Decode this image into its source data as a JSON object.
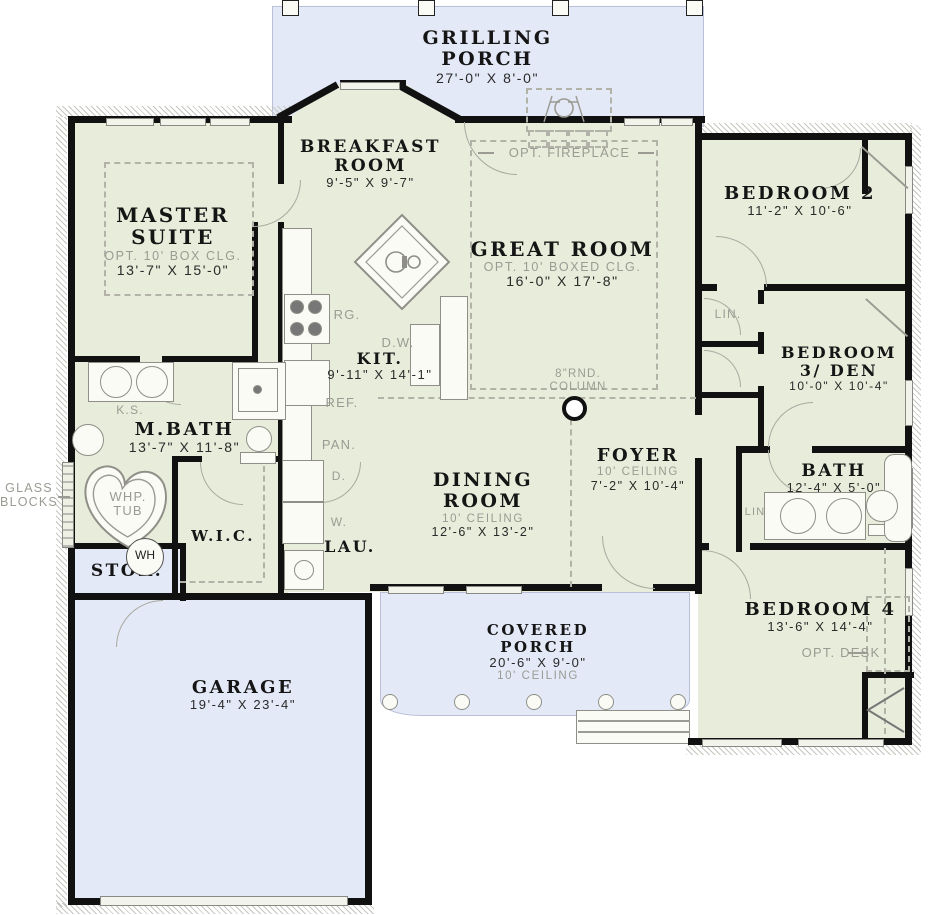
{
  "title": "Floor Plan",
  "colors": {
    "interior": "#e7edda",
    "porch": "#e4e9f7",
    "wall": "#111111",
    "annotation": "#9b9b93"
  },
  "rooms": {
    "grilling_porch": {
      "name": "GRILLING PORCH",
      "dims": "27'-0\" X 8'-0\""
    },
    "breakfast": {
      "name": "BREAKFAST ROOM",
      "dims": "9'-5\" X 9'-7\""
    },
    "master": {
      "name": "MASTER SUITE",
      "opt": "OPT. 10' BOX CLG.",
      "dims": "13'-7\" X 15'-0\""
    },
    "great_room": {
      "name": "GREAT ROOM",
      "opt": "OPT. 10' BOXED CLG.",
      "dims": "16'-0\" X 17'-8\""
    },
    "bedroom2": {
      "name": "BEDROOM 2",
      "dims": "11'-2\" X 10'-6\""
    },
    "kitchen": {
      "name": "KIT.",
      "dims": "9'-11\" X 14'-1\""
    },
    "bedroom3": {
      "name": "BEDROOM 3/ DEN",
      "dims": "10'-0\" X 10'-4\""
    },
    "mbath": {
      "name": "M.BATH",
      "dims": "13'-7\" X 11'-8\""
    },
    "foyer": {
      "name": "FOYER",
      "ceiling": "10' CEILING",
      "dims": "7'-2\" X 10'-4\""
    },
    "bath": {
      "name": "BATH",
      "dims": "12'-4\" X 5'-0\""
    },
    "dining": {
      "name": "DINING ROOM",
      "ceiling": "10' CEILING",
      "dims": "12'-6\" X 13'-2\""
    },
    "wic": {
      "name": "W.I.C."
    },
    "laundry": {
      "name": "LAU."
    },
    "storage": {
      "name": "STOR."
    },
    "bedroom4": {
      "name": "BEDROOM 4",
      "dims": "13'-6\" X 14'-4\""
    },
    "covered_porch": {
      "name": "COVERED PORCH",
      "dims": "20'-6\" X 9'-0\"",
      "ceiling": "10' CEILING"
    },
    "garage": {
      "name": "GARAGE",
      "dims": "19'-4\" X 23'-4\""
    }
  },
  "annotations": {
    "opt_fireplace": "OPT. FIREPLACE",
    "round_column": "8\"RND. COLUMN",
    "glass_blocks": "GLASS BLOCKS",
    "whp_tub": "WHP. TUB",
    "knee_space": "K.S.",
    "range": "RG.",
    "dishwasher": "D.W.",
    "refrigerator": "REF.",
    "pantry": "PAN.",
    "linen_hall": "LIN.",
    "linen_bath": "LIN",
    "dryer": "D.",
    "washer": "W.",
    "water_heater": "WH",
    "opt_desk": "OPT. DESK"
  }
}
